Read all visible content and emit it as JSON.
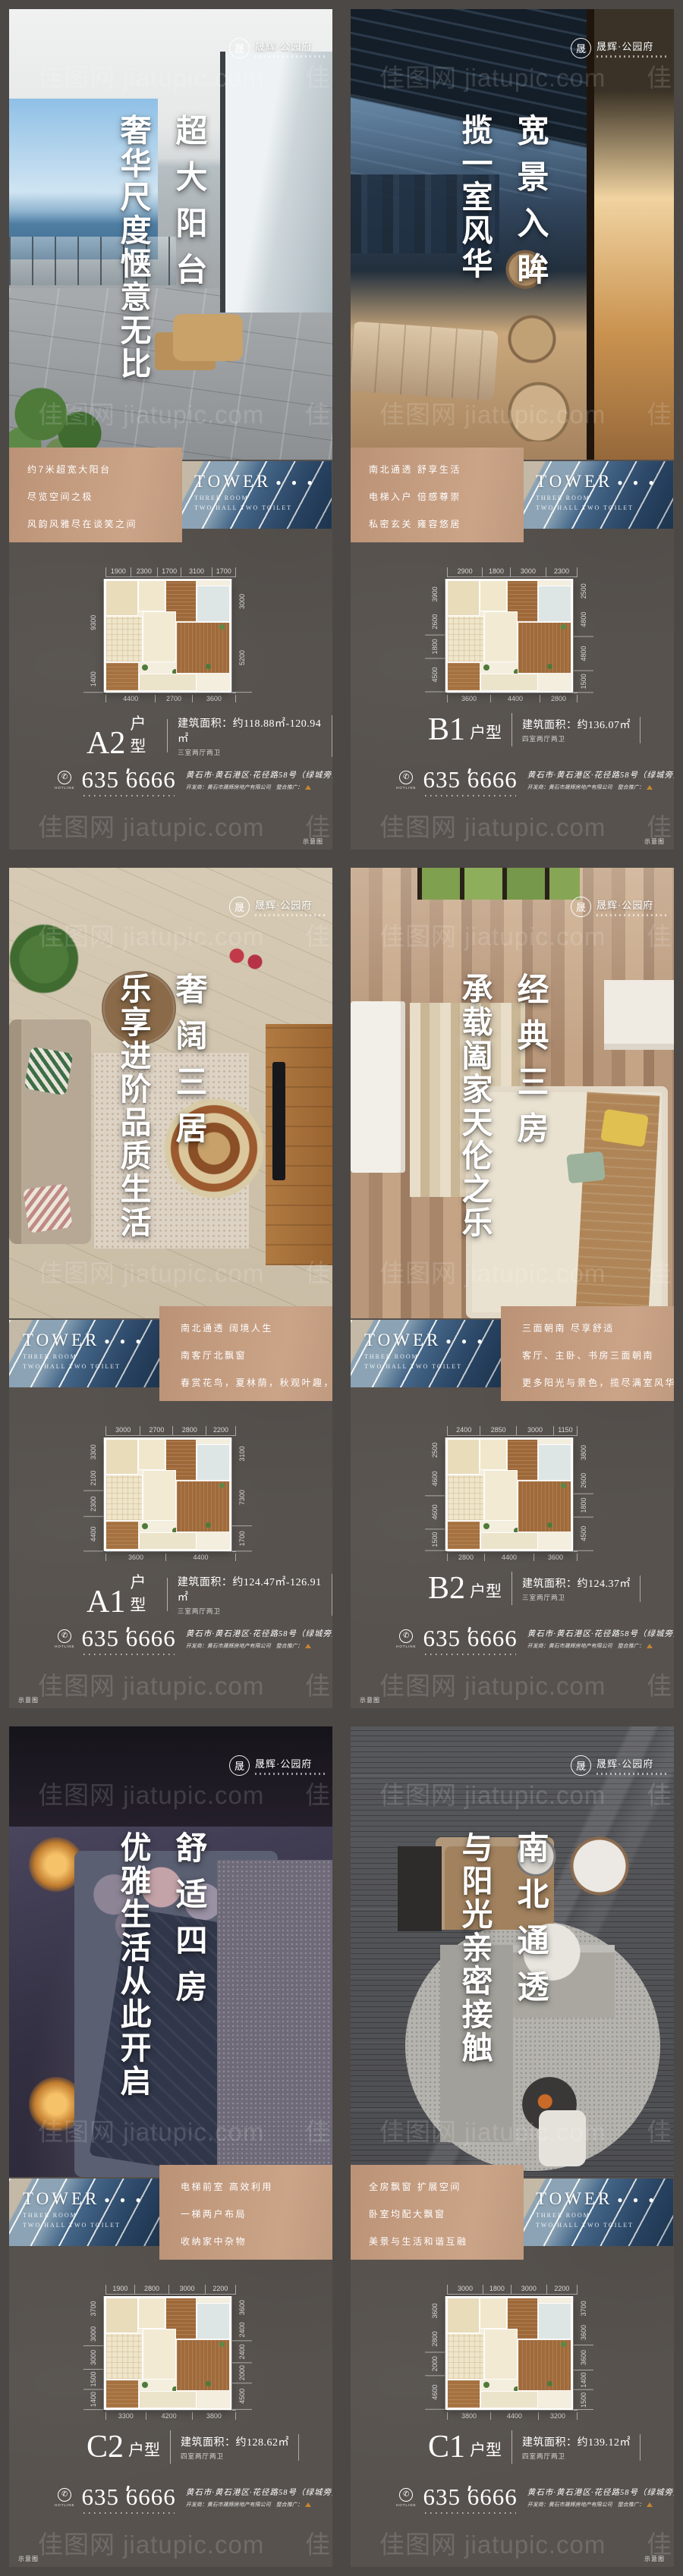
{
  "labels": {
    "watermark": "佳图网 jiatupic.com",
    "schematic": "示意图"
  },
  "brand": {
    "logo_mark": "晟",
    "name": "晟辉·公园府"
  },
  "tower": {
    "title": "TOWER",
    "dots": "● ● ●",
    "subtitle1": "THREE ROOM",
    "subtitle2": "TWO HALL TWO TOILET"
  },
  "contact": {
    "hotline_label": "HOTLINE",
    "phone": "635 6666",
    "address": "黄石市·黄石港区·花径路58号（绿城旁）",
    "developer_line": "开发商：黄石市晟辉房地产有限公司　整合推广："
  },
  "colors": {
    "accent_tan": "#c39a7d",
    "poster_bg": "#57524e",
    "stripe_blue": "#2c486a"
  },
  "posters": [
    {
      "id": "A2",
      "headline_right": "超大阳台",
      "headline_left": "奢华尺度惬意无比",
      "box_lines": [
        "约7米超宽大阳台",
        "尽览空间之极",
        "风韵风雅尽在谈笑之间"
      ],
      "plan": {
        "top": [
          "1900",
          "2300",
          "1700",
          "3100",
          "1700"
        ],
        "left": [
          "9300",
          "1400"
        ],
        "right": [
          "3000",
          "5200"
        ],
        "bottom": [
          "4400",
          "2700",
          "3600"
        ]
      },
      "unit": {
        "name": "A2",
        "suffix": "户型",
        "area": "建筑面积：约118.88㎡-120.94㎡",
        "rooms": "三室两厅两卫"
      }
    },
    {
      "id": "B1",
      "headline_right": "宽景入眸",
      "headline_left": "揽一室风华",
      "box_lines": [
        "南北通透 舒享生活",
        "电梯入户 倍感尊崇",
        "私密玄关 雍容悠居"
      ],
      "plan": {
        "top": [
          "2900",
          "1800",
          "3000",
          "2300"
        ],
        "left": [
          "3900",
          "2600",
          "1800",
          "4500"
        ],
        "right": [
          "2500",
          "4800",
          "4800",
          "1500"
        ],
        "bottom": [
          "3600",
          "4400",
          "2800"
        ]
      },
      "unit": {
        "name": "B1",
        "suffix": "户型",
        "area": "建筑面积：约136.07㎡",
        "rooms": "四室两厅两卫"
      }
    },
    {
      "id": "A1",
      "headline_right": "奢阔三居",
      "headline_left": "乐享进阶品质生活",
      "box_lines": [
        "南北通透 阔境人生",
        "南客厅北飘窗",
        "春赏花鸟，夏林荫，秋观叶趣，冬沐阳"
      ],
      "plan": {
        "top": [
          "3000",
          "2700",
          "2800",
          "2200"
        ],
        "left": [
          "3300",
          "2100",
          "2300",
          "4400"
        ],
        "right": [
          "3100",
          "7300",
          "1700"
        ],
        "bottom": [
          "3600",
          "4400"
        ]
      },
      "unit": {
        "name": "A1",
        "suffix": "户型",
        "area": "建筑面积：约124.47㎡-126.91㎡",
        "rooms": "三室两厅两卫"
      }
    },
    {
      "id": "B2",
      "headline_right": "经典三房",
      "headline_left": "承载阖家天伦之乐",
      "box_lines": [
        "三面朝南 尽享舒适",
        "客厅、主卧、书房三面朝南",
        "更多阳光与景色，揽尽满室风华"
      ],
      "plan": {
        "top": [
          "2400",
          "2850",
          "3000",
          "1150"
        ],
        "left": [
          "2500",
          "4600",
          "4600",
          "1500"
        ],
        "right": [
          "3800",
          "2600",
          "1800",
          "4500"
        ],
        "bottom": [
          "2800",
          "4400",
          "3600"
        ]
      },
      "unit": {
        "name": "B2",
        "suffix": "户型",
        "area": "建筑面积：约124.37㎡",
        "rooms": "三室两厅两卫"
      }
    },
    {
      "id": "C2",
      "headline_right": "舒适四房",
      "headline_left": "优雅生活从此开启",
      "box_lines": [
        "电梯前室 高效利用",
        "一梯两户布局",
        "收纳家中杂物"
      ],
      "plan": {
        "top": [
          "1900",
          "2800",
          "3000",
          "2200"
        ],
        "left": [
          "3700",
          "3000",
          "3000",
          "1500",
          "1400"
        ],
        "right": [
          "3600",
          "2400",
          "2400",
          "2000",
          "4500"
        ],
        "bottom": [
          "3300",
          "4200",
          "3800"
        ]
      },
      "unit": {
        "name": "C2",
        "suffix": "户型",
        "area": "建筑面积：约128.62㎡",
        "rooms": "四室两厅两卫"
      }
    },
    {
      "id": "C1",
      "headline_right": "南北通透",
      "headline_left": "与阳光亲密接触",
      "box_lines": [
        "全房飘窗 扩展空间",
        "卧室均配大飘窗",
        "美景与生活和谐互融"
      ],
      "plan": {
        "top": [
          "3000",
          "1800",
          "3000",
          "2200"
        ],
        "left": [
          "3600",
          "2800",
          "2000",
          "4600"
        ],
        "right": [
          "3700",
          "3600",
          "3600",
          "1400",
          "1500"
        ],
        "bottom": [
          "3800",
          "4400",
          "3200"
        ]
      },
      "unit": {
        "name": "C1",
        "suffix": "户型",
        "area": "建筑面积：约139.12㎡",
        "rooms": "四室两厅两卫"
      }
    }
  ]
}
